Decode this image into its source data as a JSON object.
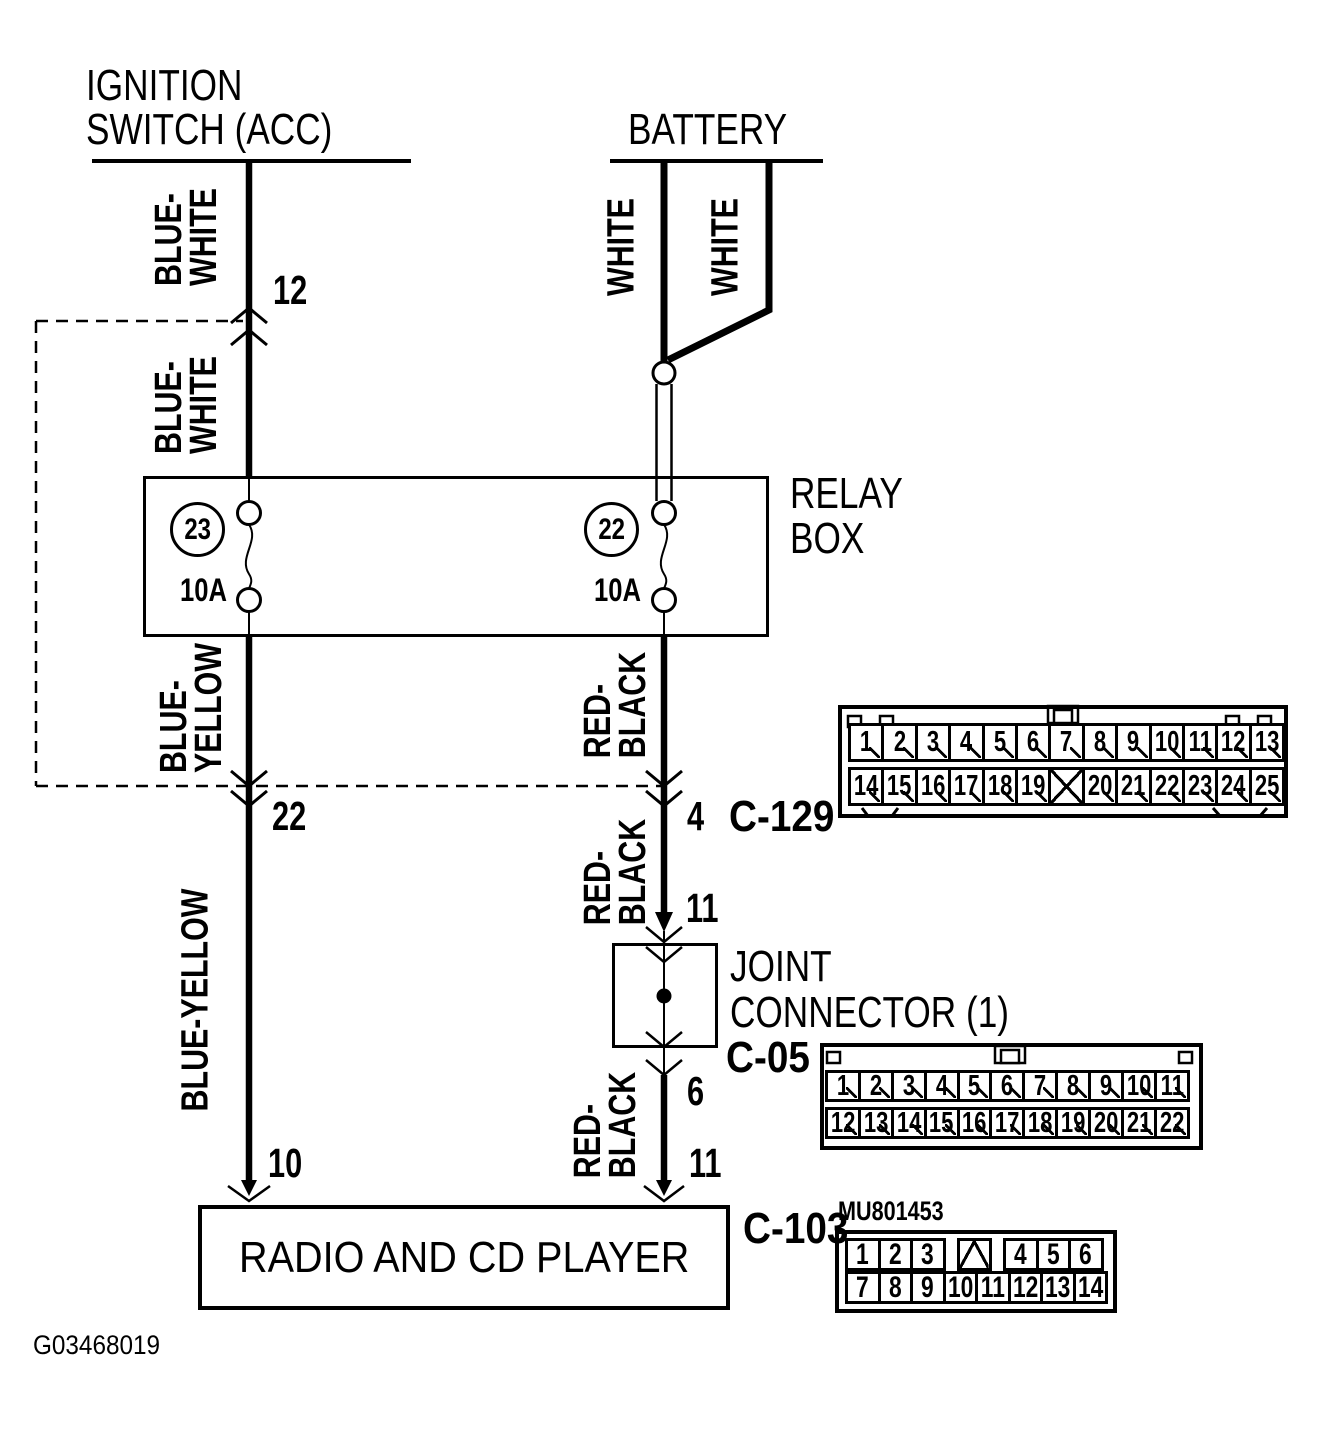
{
  "figure_id": "G03468019",
  "nodes": {
    "ignition": {
      "line1": "IGNITION",
      "line2": "SWITCH (ACC)"
    },
    "battery": {
      "label": "BATTERY"
    },
    "relay_box": {
      "line1": "RELAY",
      "line2": "BOX"
    },
    "joint_connector": {
      "line1": "JOINT",
      "line2": "CONNECTOR (1)"
    },
    "radio": {
      "label": "RADIO AND CD PLAYER"
    }
  },
  "fuses": {
    "fuse23": {
      "number": "23",
      "rating": "10A"
    },
    "fuse22": {
      "number": "22",
      "rating": "10A"
    }
  },
  "wire_labels": {
    "blue_white_1": {
      "line1": "BLUE-",
      "line2": "WHITE"
    },
    "blue_white_2": {
      "line1": "BLUE-",
      "line2": "WHITE"
    },
    "white_left": {
      "label": "WHITE"
    },
    "white_right": {
      "label": "WHITE"
    },
    "blue_yellow": {
      "line1": "BLUE-",
      "line2": "YELLOW"
    },
    "blue_yellow_long": {
      "label": "BLUE-YELLOW"
    },
    "red_black_1": {
      "line1": "RED-",
      "line2": "BLACK"
    },
    "red_black_2": {
      "line1": "RED-",
      "line2": "BLACK"
    },
    "red_black_3": {
      "line1": "RED-",
      "line2": "BLACK"
    }
  },
  "pin_numbers": {
    "ignition_branch": "12",
    "relay_left_out": "22",
    "relay_right_out": "4",
    "joint_in": "11",
    "joint_out": "6",
    "radio_left": "10",
    "radio_right": "11"
  },
  "connectors": {
    "c129": {
      "name": "C-129",
      "row1": [
        "1",
        "2",
        "3",
        "4",
        "5",
        "6",
        "7",
        "8",
        "9",
        "10",
        "11",
        "12",
        "13"
      ],
      "row2": [
        "14",
        "15",
        "16",
        "17",
        "18",
        "19",
        "X",
        "20",
        "21",
        "22",
        "23",
        "24",
        "25"
      ]
    },
    "c05": {
      "name": "C-05",
      "row1": [
        "1",
        "2",
        "3",
        "4",
        "5",
        "6",
        "7",
        "8",
        "9",
        "10",
        "11"
      ],
      "row2": [
        "12",
        "13",
        "14",
        "15",
        "16",
        "17",
        "18",
        "19",
        "20",
        "21",
        "22"
      ]
    },
    "c103": {
      "name": "C-103",
      "part_number": "MU801453",
      "row1": [
        "1",
        "2",
        "3",
        "V",
        "4",
        "5",
        "6"
      ],
      "row2": [
        "7",
        "8",
        "9",
        "10",
        "11",
        "12",
        "13",
        "14"
      ]
    }
  },
  "colors": {
    "line": "#000000",
    "background": "#ffffff"
  }
}
